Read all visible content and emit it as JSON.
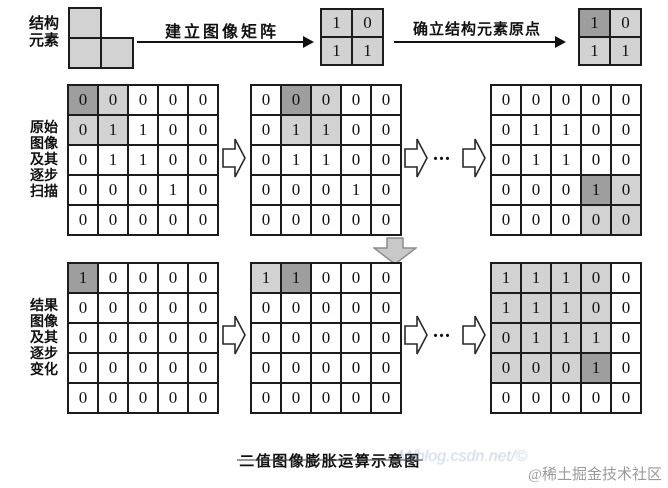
{
  "labels": {
    "se_label_lines": [
      "结构",
      "元素"
    ],
    "arrow1_label": "建立图像矩阵",
    "arrow2_label": "确立结构元素原点",
    "original_label_lines": [
      "原始",
      "图像",
      "及其",
      "逐步",
      "扫描"
    ],
    "result_label_lines": [
      "结果",
      "图像",
      "及其",
      "逐步",
      "变化"
    ],
    "ellipsis": "...",
    "caption": "二值图像膨胀运算示意图",
    "watermark_faint": "M/blog.csdn.net/©",
    "watermark_main": "@稀土掘金技术社区"
  },
  "colors": {
    "cell_light": "#d2d2d2",
    "cell_dark": "#9e9e9e",
    "cell_white": "#ffffff",
    "border": "#1c1c1c",
    "down_arrow_fill": "#c8c8c8",
    "down_arrow_stroke": "#8c8c8c"
  },
  "matrices": {
    "se_plain": {
      "values": [
        [
          1,
          0
        ],
        [
          1,
          1
        ]
      ],
      "shades": [
        [
          "L",
          "L"
        ],
        [
          "L",
          "L"
        ]
      ]
    },
    "se_origin": {
      "values": [
        [
          1,
          0
        ],
        [
          1,
          1
        ]
      ],
      "shades": [
        [
          "D",
          "L"
        ],
        [
          "L",
          "L"
        ]
      ]
    },
    "orig1": {
      "values": [
        [
          0,
          0,
          0,
          0,
          0
        ],
        [
          0,
          1,
          1,
          0,
          0
        ],
        [
          0,
          1,
          1,
          0,
          0
        ],
        [
          0,
          0,
          0,
          1,
          0
        ],
        [
          0,
          0,
          0,
          0,
          0
        ]
      ],
      "shades": [
        [
          "D",
          "L",
          "W",
          "W",
          "W"
        ],
        [
          "L",
          "L",
          "W",
          "W",
          "W"
        ],
        [
          "W",
          "W",
          "W",
          "W",
          "W"
        ],
        [
          "W",
          "W",
          "W",
          "W",
          "W"
        ],
        [
          "W",
          "W",
          "W",
          "W",
          "W"
        ]
      ]
    },
    "orig2": {
      "values": [
        [
          0,
          0,
          0,
          0,
          0
        ],
        [
          0,
          1,
          1,
          0,
          0
        ],
        [
          0,
          1,
          1,
          0,
          0
        ],
        [
          0,
          0,
          0,
          1,
          0
        ],
        [
          0,
          0,
          0,
          0,
          0
        ]
      ],
      "shades": [
        [
          "W",
          "D",
          "L",
          "W",
          "W"
        ],
        [
          "W",
          "L",
          "L",
          "W",
          "W"
        ],
        [
          "W",
          "W",
          "W",
          "W",
          "W"
        ],
        [
          "W",
          "W",
          "W",
          "W",
          "W"
        ],
        [
          "W",
          "W",
          "W",
          "W",
          "W"
        ]
      ]
    },
    "orig3": {
      "values": [
        [
          0,
          0,
          0,
          0,
          0
        ],
        [
          0,
          1,
          1,
          0,
          0
        ],
        [
          0,
          1,
          1,
          0,
          0
        ],
        [
          0,
          0,
          0,
          1,
          0
        ],
        [
          0,
          0,
          0,
          0,
          0
        ]
      ],
      "shades": [
        [
          "W",
          "W",
          "W",
          "W",
          "W"
        ],
        [
          "W",
          "W",
          "W",
          "W",
          "W"
        ],
        [
          "W",
          "W",
          "W",
          "W",
          "W"
        ],
        [
          "W",
          "W",
          "W",
          "D",
          "L"
        ],
        [
          "W",
          "W",
          "W",
          "L",
          "L"
        ]
      ]
    },
    "res1": {
      "values": [
        [
          1,
          0,
          0,
          0,
          0
        ],
        [
          0,
          0,
          0,
          0,
          0
        ],
        [
          0,
          0,
          0,
          0,
          0
        ],
        [
          0,
          0,
          0,
          0,
          0
        ],
        [
          0,
          0,
          0,
          0,
          0
        ]
      ],
      "shades": [
        [
          "D",
          "W",
          "W",
          "W",
          "W"
        ],
        [
          "W",
          "W",
          "W",
          "W",
          "W"
        ],
        [
          "W",
          "W",
          "W",
          "W",
          "W"
        ],
        [
          "W",
          "W",
          "W",
          "W",
          "W"
        ],
        [
          "W",
          "W",
          "W",
          "W",
          "W"
        ]
      ]
    },
    "res2": {
      "values": [
        [
          1,
          1,
          0,
          0,
          0
        ],
        [
          0,
          0,
          0,
          0,
          0
        ],
        [
          0,
          0,
          0,
          0,
          0
        ],
        [
          0,
          0,
          0,
          0,
          0
        ],
        [
          0,
          0,
          0,
          0,
          0
        ]
      ],
      "shades": [
        [
          "L",
          "D",
          "W",
          "W",
          "W"
        ],
        [
          "W",
          "W",
          "W",
          "W",
          "W"
        ],
        [
          "W",
          "W",
          "W",
          "W",
          "W"
        ],
        [
          "W",
          "W",
          "W",
          "W",
          "W"
        ],
        [
          "W",
          "W",
          "W",
          "W",
          "W"
        ]
      ]
    },
    "res3": {
      "values": [
        [
          1,
          1,
          1,
          0,
          0
        ],
        [
          1,
          1,
          1,
          0,
          0
        ],
        [
          0,
          1,
          1,
          1,
          0
        ],
        [
          0,
          0,
          0,
          1,
          0
        ],
        [
          0,
          0,
          0,
          0,
          0
        ]
      ],
      "shades": [
        [
          "L",
          "L",
          "L",
          "L",
          "W"
        ],
        [
          "L",
          "L",
          "L",
          "L",
          "W"
        ],
        [
          "L",
          "L",
          "L",
          "L",
          "W"
        ],
        [
          "L",
          "L",
          "L",
          "D",
          "W"
        ],
        [
          "W",
          "W",
          "W",
          "W",
          "W"
        ]
      ]
    }
  }
}
